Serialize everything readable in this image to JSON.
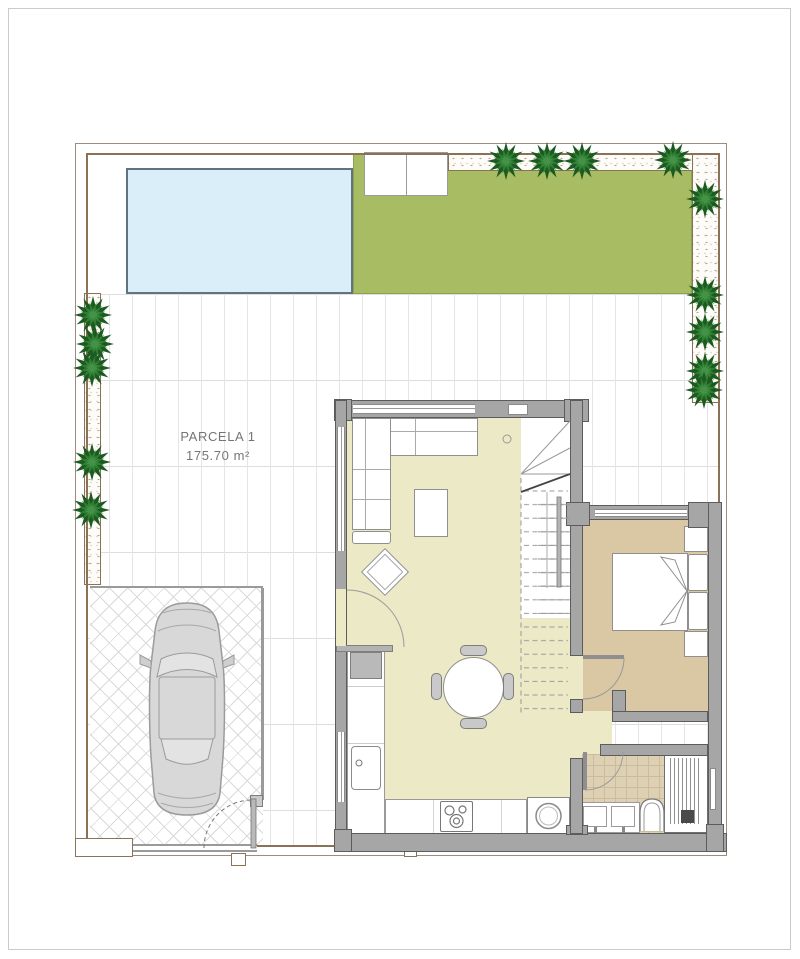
{
  "plan": {
    "parcel": {
      "name": "PARCELA 1",
      "area": "175.70 m²"
    }
  },
  "palette": {
    "boundary": "#8b7257",
    "wall": "#a6a6a6",
    "pool": "#d9eef8",
    "lawn": "#a8bc63",
    "living_floor": "#ebe9c6",
    "bedroom_floor": "#d9c8a3",
    "bathroom_tile": "#ded0b3",
    "tree": "#2e7d32",
    "car": "#d8d8d8"
  },
  "counts": {
    "trees": 14,
    "cars": 1
  }
}
